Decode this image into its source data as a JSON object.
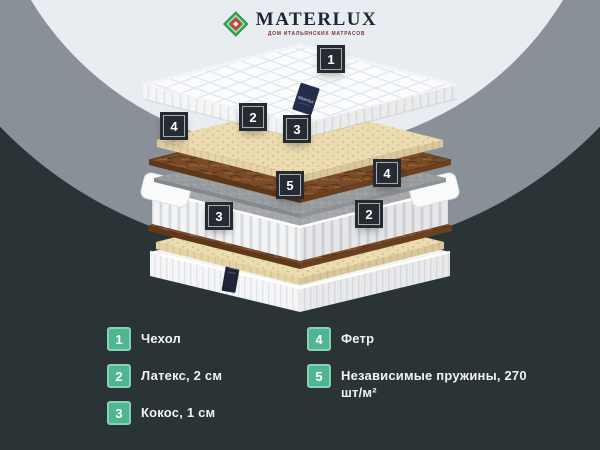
{
  "logo": {
    "brand": "MATERLUX",
    "tagline": "ДОМ ИТАЛЬЯНСКИХ МАТРАСОВ",
    "mark_green": "#2f9e49",
    "mark_red": "#cf2e28"
  },
  "diagram": {
    "tag_text": "Materlux",
    "callouts": [
      {
        "number": "1",
        "layer": "cover"
      },
      {
        "number": "2",
        "layer": "latex-top"
      },
      {
        "number": "3",
        "layer": "coconut-top"
      },
      {
        "number": "4",
        "layer": "felt-top"
      },
      {
        "number": "5",
        "layer": "springs"
      },
      {
        "number": "4",
        "layer": "felt-bottom"
      },
      {
        "number": "3",
        "layer": "coconut-bottom"
      },
      {
        "number": "2",
        "layer": "latex-bottom"
      }
    ]
  },
  "legend": {
    "items": [
      {
        "number": "1",
        "label": "Чехол"
      },
      {
        "number": "2",
        "label": "Латекс, 2 см"
      },
      {
        "number": "3",
        "label": "Кокос, 1 см"
      },
      {
        "number": "4",
        "label": "Фетр"
      },
      {
        "number": "5",
        "label": "Независимые пружины, 270 шт/м²"
      }
    ],
    "badge_color": "#4fb593"
  },
  "colors": {
    "background": "#2a3336",
    "circle_outer": "#8a9097",
    "circle_inner": "#e9ecf1",
    "callout_bg": "#262b31"
  }
}
